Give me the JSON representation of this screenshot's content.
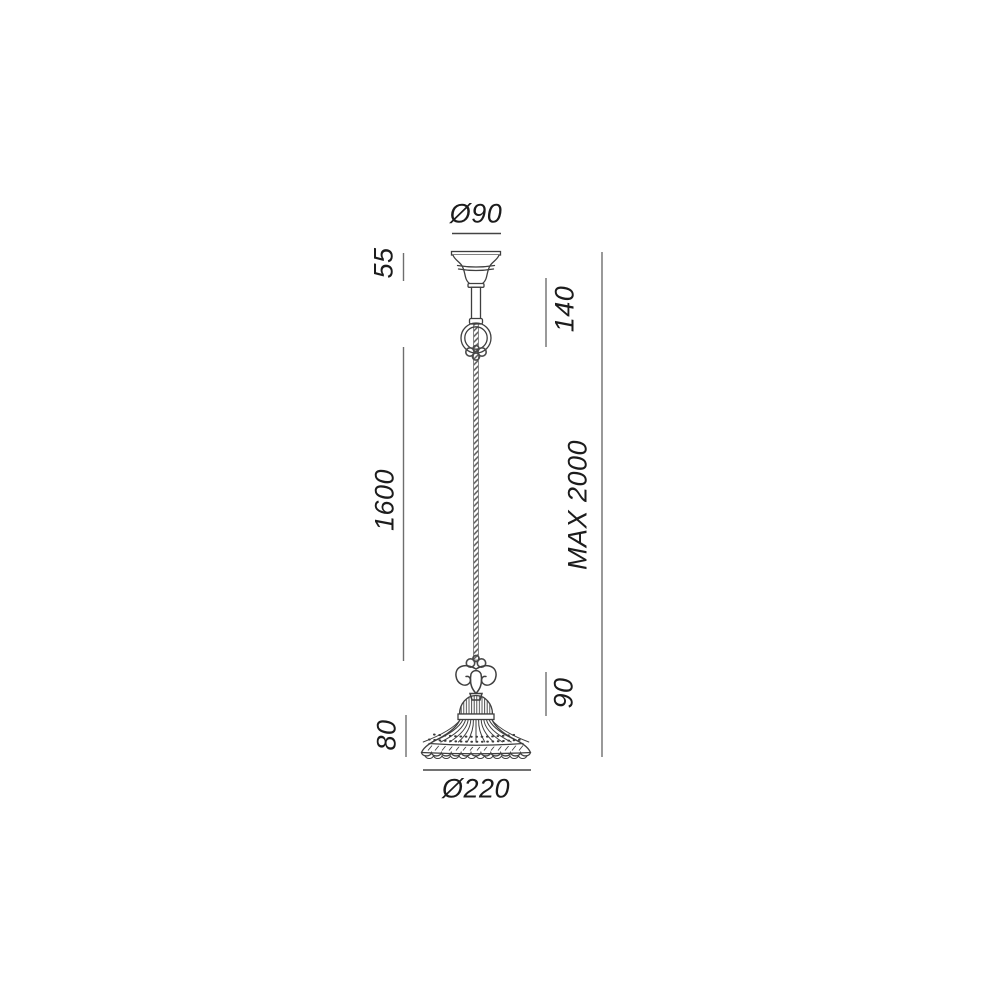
{
  "drawing": {
    "title": "pendant-lamp-dimension-drawing",
    "dimensions": {
      "canopy_diameter": "Ø90",
      "canopy_height": "55",
      "top_section_height": "140",
      "cable_length": "1600",
      "max_drop": "MAX 2000",
      "holder_height": "90",
      "shade_height": "80",
      "shade_diameter": "Ø220"
    },
    "colors": {
      "line": "#3f3f3f",
      "dim_line": "#6e6e6e",
      "text": "#1c1c1c",
      "background": "#ffffff"
    }
  }
}
